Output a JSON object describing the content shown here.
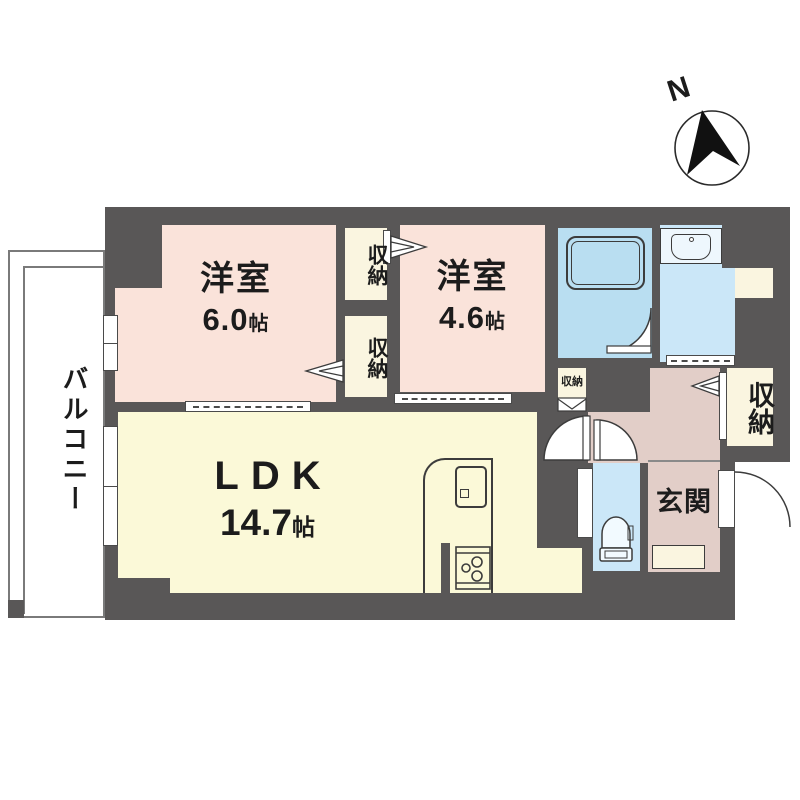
{
  "compass": {
    "north_label": "N"
  },
  "balcony": {
    "label": "バルコニー"
  },
  "bedroom1": {
    "label": "洋室",
    "area": "6.0",
    "area_unit": "帖"
  },
  "bedroom2": {
    "label": "洋室",
    "area": "4.6",
    "area_unit": "帖"
  },
  "ldk": {
    "label": "LDK",
    "area": "14.7",
    "area_unit": "帖"
  },
  "entrance": {
    "label": "玄関"
  },
  "storages": {
    "middle_top": "収納",
    "middle_bottom": "収納",
    "hall_small": "収納",
    "entrance_side": "収納"
  },
  "colors": {
    "wall": "#595757",
    "bedroom": "#FAE3DA",
    "ldk": "#FBF9D8",
    "storage": "#FAF5E0",
    "bath": "#B9DEF1",
    "sanitary": "#CBE7F8",
    "hall": "#E2CEC8"
  }
}
